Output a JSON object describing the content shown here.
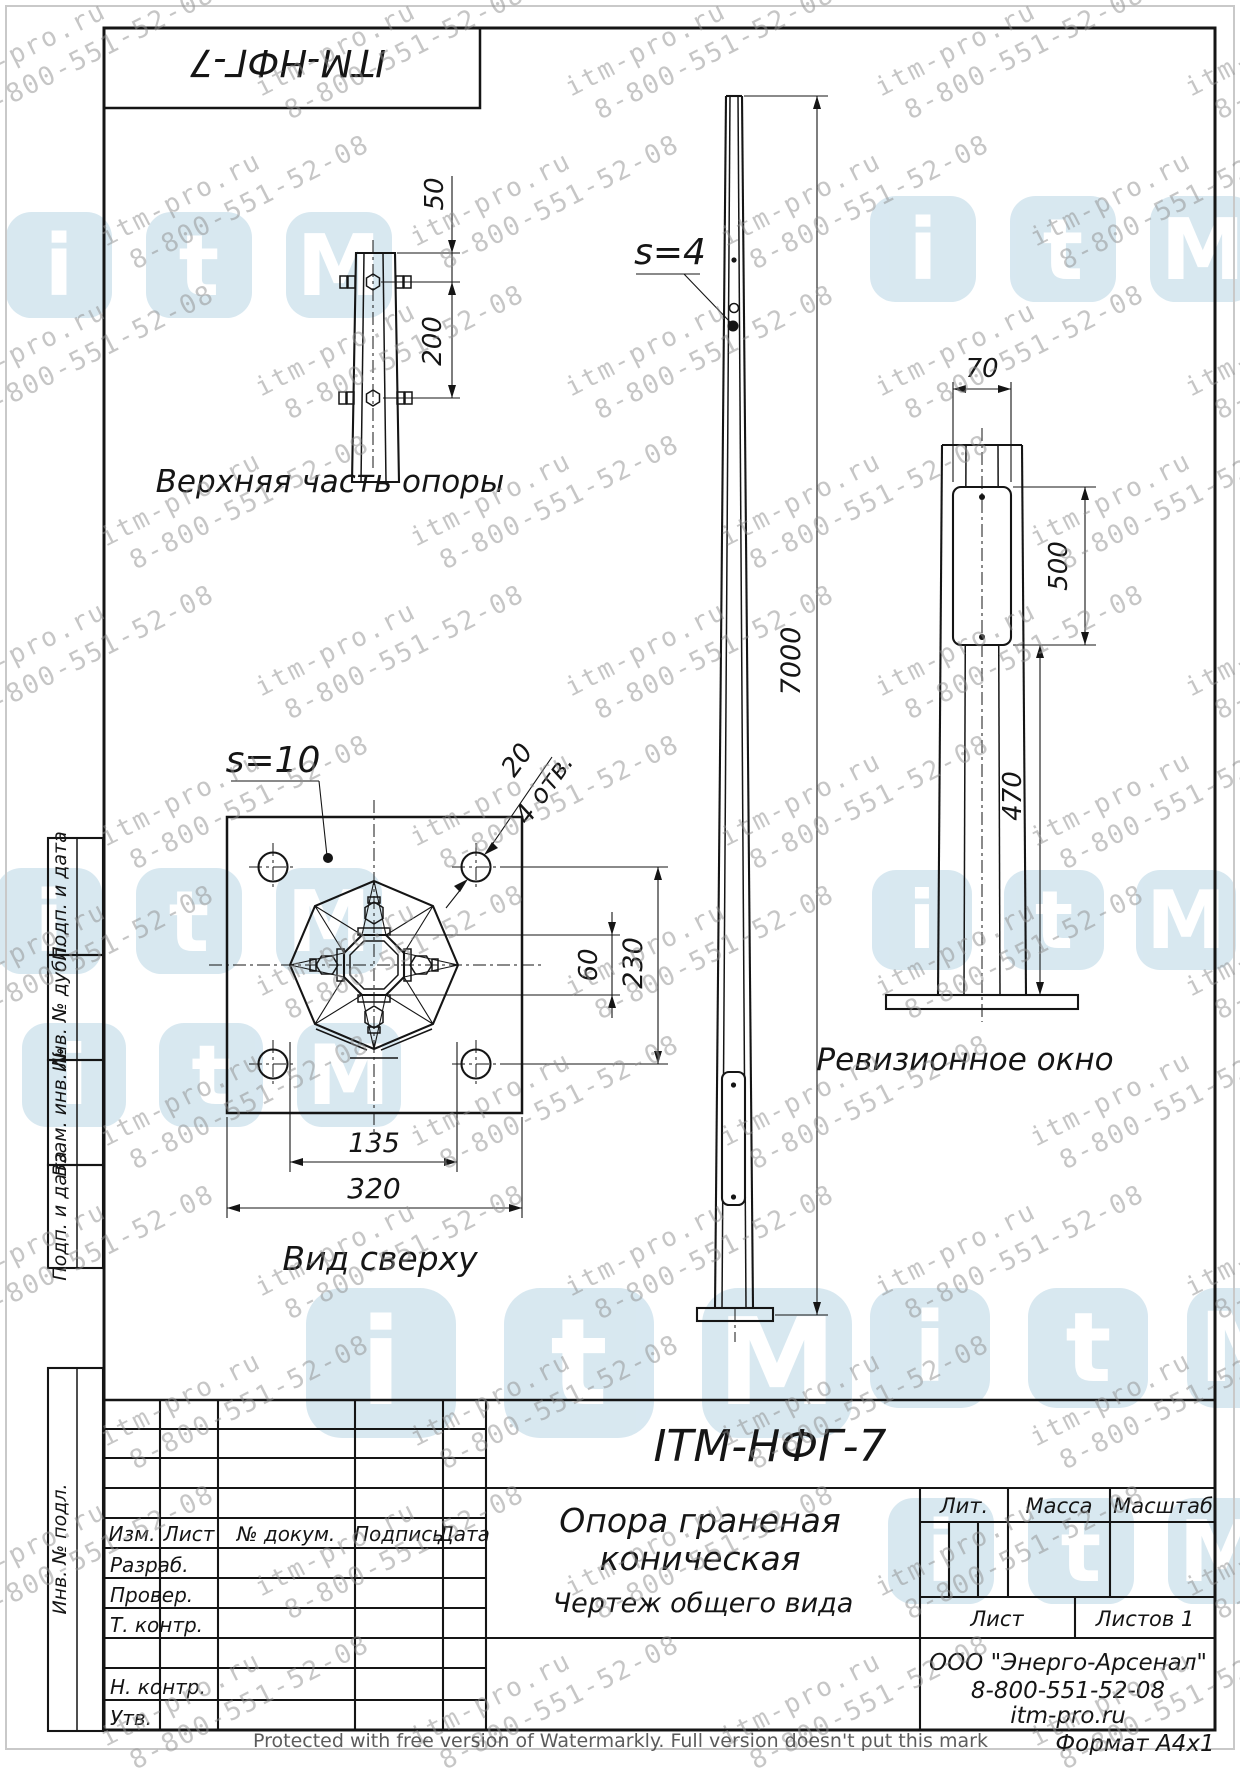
{
  "stamp": {
    "designation": "ITM-НФГ-7"
  },
  "watermark": {
    "site": "itm-pro.ru",
    "phone": "8-800-551-52-08",
    "logo_letters": [
      "i",
      "t",
      "M"
    ],
    "protected_note": "Protected with free version of Watermarkly. Full version doesn't put this mark"
  },
  "drawings": {
    "top_part": {
      "label": "Верхняя часть опоры",
      "dim_50": "50",
      "dim_200": "200"
    },
    "front_view": {
      "thickness_label": "s=4",
      "dim_height": "7000"
    },
    "top_view": {
      "label": "Вид сверху",
      "thickness_label": "s=10",
      "dim_hole": "20",
      "dim_hole_note": "4 отв.",
      "dim_60": "60",
      "dim_230": "230",
      "dim_135": "135",
      "dim_320": "320"
    },
    "revision_window": {
      "label": "Ревизионное окно",
      "dim_70": "70",
      "dim_500": "500",
      "dim_470": "470"
    }
  },
  "title_block": {
    "designation": "ITM-НФГ-7",
    "name_line1": "Опора граненая",
    "name_line2": "коническая",
    "doc_type": "Чертеж общего вида",
    "col_izm": "Изм.",
    "col_list": "Лист",
    "col_doc": "№ докум.",
    "col_sign": "Подпись",
    "col_date": "Дата",
    "row_razrab": "Разраб.",
    "row_prover": "Провер.",
    "row_tkontr": "Т. контр.",
    "row_nkontr": "Н. контр.",
    "row_utv": "Утв.",
    "lit": "Лит.",
    "massa": "Масса",
    "masshtab": "Масштаб",
    "list": "Лист",
    "listov": "Листов 1",
    "company_line1": "ООО \"Энерго-Арсенал\"",
    "company_line2": "8-800-551-52-08",
    "company_line3": "itm-pro.ru",
    "format": "Формат  А4х1"
  },
  "sidebar": {
    "items": [
      {
        "label": "Подп. и дата"
      },
      {
        "label": "Инв. № дубл."
      },
      {
        "label": "Взам. инв. №"
      },
      {
        "label": "Подп. и дата"
      },
      {
        "label": "Инв. № подл."
      }
    ]
  }
}
